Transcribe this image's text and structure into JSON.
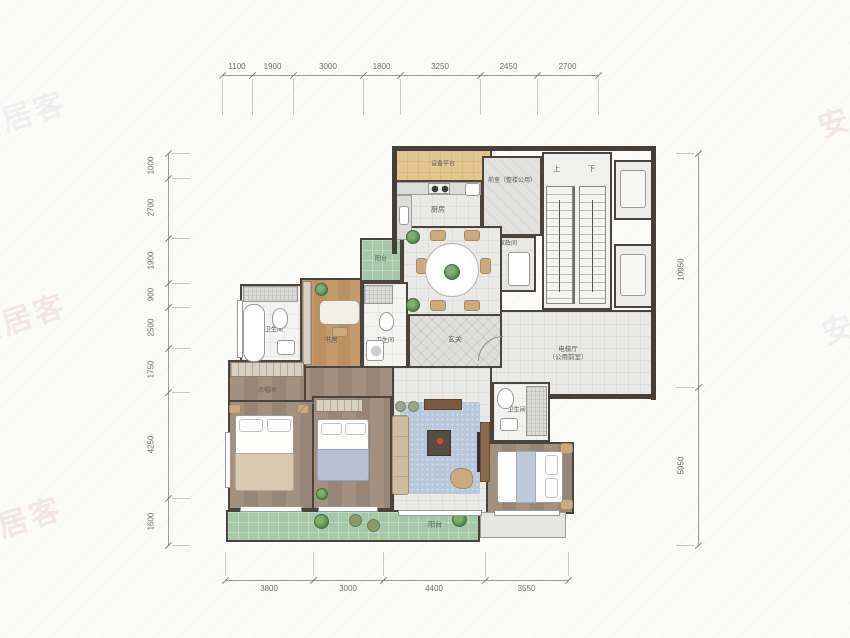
{
  "watermark": "安居客",
  "dimensions": {
    "top": [
      "1100",
      "1900",
      "3000",
      "1800",
      "3250",
      "2450",
      "2700"
    ],
    "bottom": [
      "3800",
      "3000",
      "4400",
      "3550"
    ],
    "left": [
      "1000",
      "2700",
      "1900",
      "900",
      "2500",
      "1750",
      "4250",
      "1600"
    ],
    "right": [
      "10050",
      "5950"
    ]
  },
  "rooms": {
    "equipment_platform": "设备平台",
    "kitchen": "厨房",
    "front_room": "前室（整楼公用）",
    "housekeeping": "家政间",
    "elevator_hall_1": "电梯厅",
    "elevator_hall_2": "（公用前室）",
    "dining": "餐厅",
    "foyer": "玄关",
    "study": "书房",
    "bath": "卫生间",
    "cloakroom": "衣帽间",
    "master_bedroom": "主卧",
    "bedroom": "卧室",
    "living": "客厅",
    "balcony": "阳台",
    "balcony_small": "阳台"
  },
  "stairs": {
    "up": "上",
    "down": "下"
  },
  "colors": {
    "wall": "#4a443d",
    "tile": "#e9e9e7",
    "study_wood": "#c59a6b",
    "bedroom_wood": "#9d8b7c",
    "balcony_green": "#a6c8a9",
    "rug_blue": "#b9c7da",
    "platform_tan": "#e3c58e",
    "dimension_text": "#6e6e6c"
  }
}
